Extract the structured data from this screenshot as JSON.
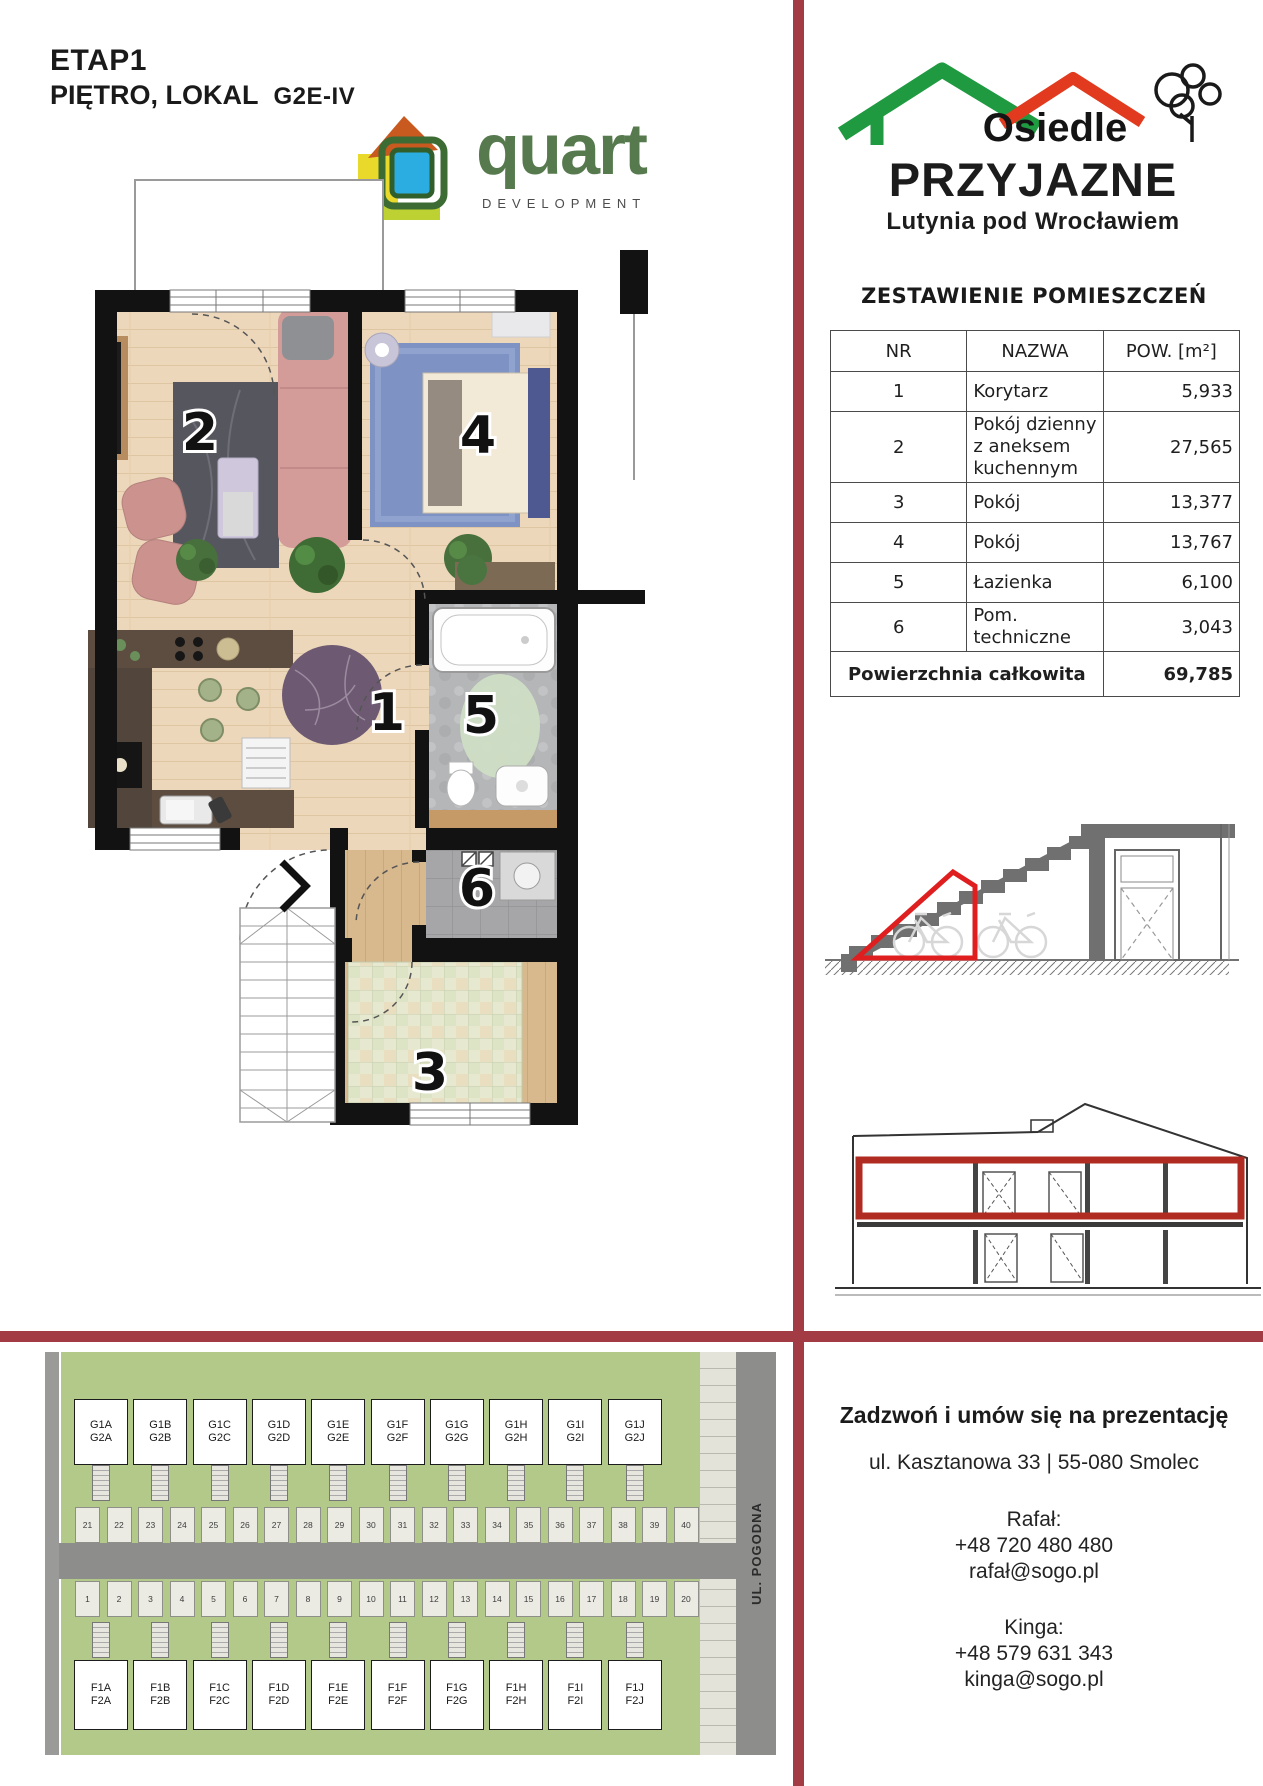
{
  "header": {
    "etap_label": "ETAP",
    "etap_number": "1",
    "floor_label": "PIĘTRO, LOKAL",
    "unit_code": "G2E-IV"
  },
  "developer_logo": {
    "name": "quart",
    "subtitle": "DEVELOPMENT"
  },
  "estate_logo": {
    "line1": "Osiedle",
    "line2": "PRZYJAZNE",
    "line3": "Lutynia pod Wrocławiem"
  },
  "rooms_table": {
    "title": "ZESTAWIENIE POMIESZCZEŃ",
    "headers": {
      "nr": "NR",
      "name": "NAZWA",
      "area": "POW. [m²]"
    },
    "rows": [
      {
        "nr": "1",
        "name": "Korytarz",
        "area": "5,933"
      },
      {
        "nr": "2",
        "name": "Pokój dzienny z aneksem kuchennym",
        "area": "27,565"
      },
      {
        "nr": "3",
        "name": "Pokój",
        "area": "13,377"
      },
      {
        "nr": "4",
        "name": "Pokój",
        "area": "13,767"
      },
      {
        "nr": "5",
        "name": "Łazienka",
        "area": "6,100"
      },
      {
        "nr": "6",
        "name": "Pom. techniczne",
        "area": "3,043"
      }
    ],
    "footer": {
      "label": "Powierzchnia całkowita",
      "area": "69,785"
    }
  },
  "floor_plan": {
    "room_labels": {
      "r1": "1",
      "r2": "2",
      "r3": "3",
      "r4": "4",
      "r5": "5",
      "r6": "6"
    }
  },
  "site_plan": {
    "street_label": "UL. POGODNA",
    "row_g": [
      [
        "G1A",
        "G2A"
      ],
      [
        "G1B",
        "G2B"
      ],
      [
        "G1C",
        "G2C"
      ],
      [
        "G1D",
        "G2D"
      ],
      [
        "G1E",
        "G2E"
      ],
      [
        "G1F",
        "G2F"
      ],
      [
        "G1G",
        "G2G"
      ],
      [
        "G1H",
        "G2H"
      ],
      [
        "G1I",
        "G2I"
      ],
      [
        "G1J",
        "G2J"
      ]
    ],
    "row_f": [
      [
        "F1A",
        "F2A"
      ],
      [
        "F1B",
        "F2B"
      ],
      [
        "F1C",
        "F2C"
      ],
      [
        "F1D",
        "F2D"
      ],
      [
        "F1E",
        "F2E"
      ],
      [
        "F1F",
        "F2F"
      ],
      [
        "F1G",
        "F2G"
      ],
      [
        "F1H",
        "F2H"
      ],
      [
        "F1I",
        "F2I"
      ],
      [
        "F1J",
        "F2J"
      ]
    ],
    "plots_top": [
      "21",
      "22",
      "23",
      "24",
      "25",
      "26",
      "27",
      "28",
      "29",
      "30",
      "31",
      "32",
      "33",
      "34",
      "35",
      "36",
      "37",
      "38",
      "39",
      "40"
    ],
    "plots_bottom": [
      "1",
      "2",
      "3",
      "4",
      "5",
      "6",
      "7",
      "8",
      "9",
      "10",
      "11",
      "12",
      "13",
      "14",
      "15",
      "16",
      "17",
      "18",
      "19",
      "20"
    ]
  },
  "contact": {
    "title": "Zadzwoń i umów się na prezentację",
    "address": "ul. Kasztanowa 33 | 55-080 Smolec",
    "agents": [
      {
        "name": "Rafał:",
        "phone": "+48 720 480 480",
        "email": "rafał@sogo.pl"
      },
      {
        "name": "Kinga:",
        "phone": "+48 579 631 343",
        "email": "kinga@sogo.pl"
      }
    ]
  },
  "colors": {
    "accent_red": "#a23b43",
    "highlight_red": "#df1f1f",
    "quart_green": "#567a4e",
    "estate_green": "#1f9a41",
    "estate_red": "#e23a1e",
    "site_green": "#b2c98a"
  }
}
